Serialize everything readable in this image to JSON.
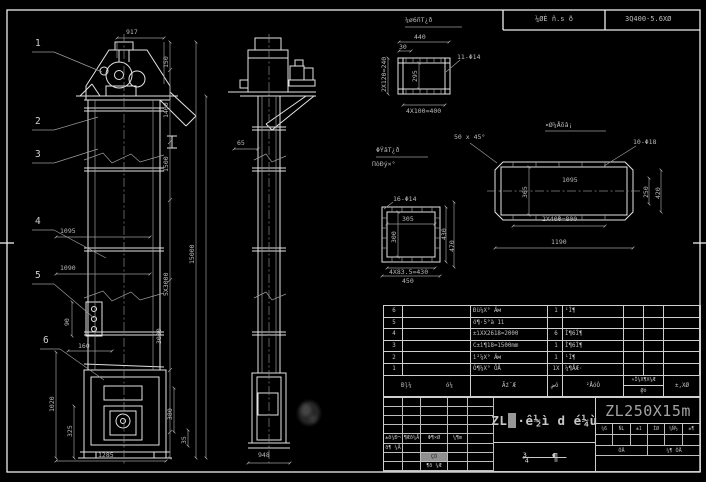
{
  "top_strip": {
    "left": "¼ØÈ ñ.s ð",
    "right": "3Q400-5.6XØ"
  },
  "balloons": [
    "1",
    "2",
    "3",
    "4",
    "5",
    "6"
  ],
  "dims": {
    "f917": "917",
    "f150": "150",
    "f1400": "1400",
    "f1500": "1500",
    "f5x3000": "5X3000",
    "f3000": "3000",
    "f15000": "15000",
    "f1095": "1095",
    "f1090": "1090",
    "f90": "90",
    "f160": "160",
    "f1020": "1020",
    "f325": "325",
    "f1285": "1285",
    "f380": "380",
    "f35": "35",
    "s65": "65",
    "s948": "948",
    "a_title": "¼ø6ñΤ¿ð",
    "a440": "440",
    "a30": "30",
    "a_holes": "11-Φ14",
    "a_left": "2X120=240",
    "a_inner": "295",
    "a_bottom": "4X100=400",
    "b_title": "¤Ø¼Åõâ¡",
    "b_chamfer": "50 x 45°",
    "b_holes": "10-Φ18",
    "b1095": "1095",
    "b365": "365",
    "b250": "250",
    "b420": "420",
    "b800": "2X400=800",
    "b1190": "1190",
    "c_title": "ΦΫâΤ¿ð",
    "c_sub": "ΠòĐý×°",
    "c_holes": "16-Φ14",
    "c305": "305",
    "c300": "300",
    "c430": "430",
    "c470": "470",
    "c_bottom": "4X83.5=430",
    "c450": "450"
  },
  "bom": {
    "rows": [
      {
        "no": "6",
        "code": "",
        "name": "Ðü¼X° Äм",
        "qty": "1",
        "mat": "¹Ì¶",
        "c6": "",
        "c7": "",
        "c8": ""
      },
      {
        "no": "5",
        "code": "",
        "name": "ö¶·5°à 1ì",
        "qty": "",
        "mat": "",
        "c6": "",
        "c7": "",
        "c8": ""
      },
      {
        "no": "4",
        "code": "",
        "name": "±ìXX2618=2000",
        "qty": "6",
        "mat": "Ì¶6Ì¶",
        "c6": "",
        "c7": "",
        "c8": ""
      },
      {
        "no": "3",
        "code": "",
        "name": "C±ì¶18=1500mm",
        "qty": "1",
        "mat": "Ì¶6Ì¶",
        "c6": "",
        "c7": "",
        "c8": ""
      },
      {
        "no": "2",
        "code": "",
        "name": "ì²¼X° Äм",
        "qty": "1",
        "mat": "¹Ì¶",
        "c6": "",
        "c7": "",
        "c8": ""
      },
      {
        "no": "1",
        "code": "",
        "name": "Ó¶¼X° ÕÅ",
        "qty": "1X",
        "mat": "¼¶ÅÆ·",
        "c6": "",
        "c7": "",
        "c8": ""
      }
    ],
    "header": {
      "no": "Ðļ¼",
      "code": "ó¼",
      "name": "Ãż¯Æ",
      "qty": "ضó",
      "mat": "²ÅóÒ",
      "split_top": "«Ì¼X¶X¼Æ",
      "split_bottom": "Ø̼ó",
      "last": "±,XØ"
    }
  },
  "titleblock": {
    "main_title_p1": "ZL",
    "main_title_p2": "¶",
    "main_title_p3": "·ê½ì d é¼ù",
    "model": "ZL250X15m",
    "drawing_label": "¾ ¶",
    "right_headers": [
      "¼6",
      "ÑL",
      "±1",
      "ÌØ",
      "¼Ñ½",
      "±¶"
    ],
    "label_a": " ÕÅ",
    "label_b": "¼¶ ÕÅ",
    "sig_cells": [
      {
        "r": 4,
        "c": 0,
        "text": "±ð¼Ð¬"
      },
      {
        "r": 4,
        "c": 1,
        "text": "¶Æð¼Å"
      },
      {
        "r": 4,
        "c": 2,
        "text": "Φ¶×Ø"
      },
      {
        "r": 4,
        "c": 3,
        "text": "¼¶m"
      },
      {
        "r": 5,
        "c": 0,
        "text": "ð¶ ¼Å"
      },
      {
        "r": 6,
        "c": 2,
        "text": "ÇÕ",
        "hl": true
      },
      {
        "r": 7,
        "c": 2,
        "text": "¶ð ¼Æ"
      }
    ]
  }
}
